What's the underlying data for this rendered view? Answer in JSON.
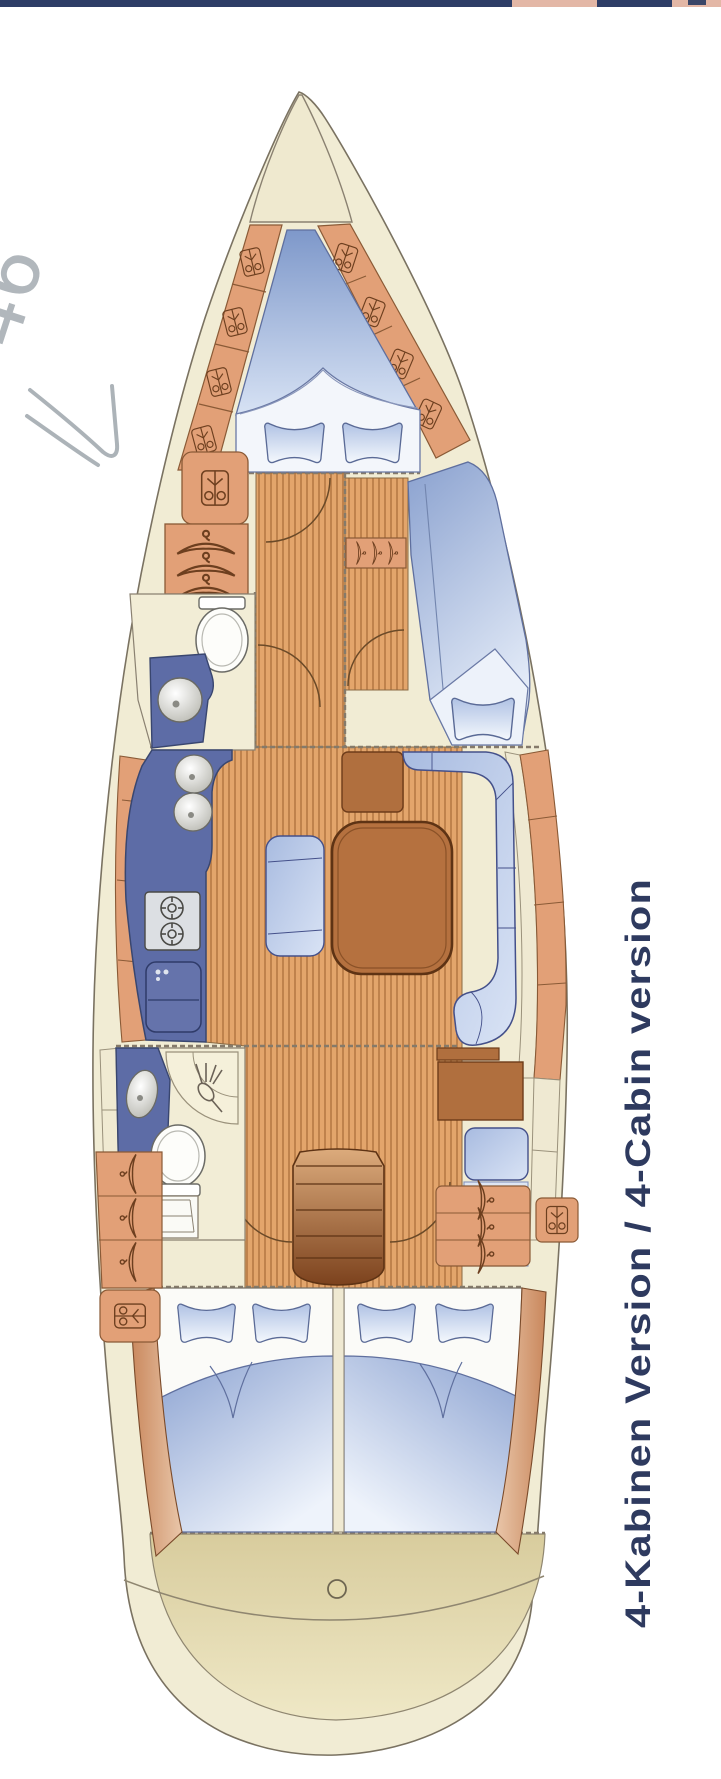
{
  "page": {
    "background": "#ffffff"
  },
  "photo_edge": {
    "navy": "#2e3d66",
    "pink": "#e3b7a6"
  },
  "handwriting": {
    "text": "46",
    "color": "#a4abb1"
  },
  "caption": {
    "text": "4-Kabinen Version / 4-Cabin version",
    "color": "#2e3a5f"
  },
  "floorplan": {
    "colors": {
      "hull_rim": "#f1ecd4",
      "anchor_locker": "#efe9cf",
      "outline": "#7a7261",
      "shelf_orange": "#e2a077",
      "shelf_line": "#8a5a36",
      "wood_light": "#e3a56b",
      "wood_stripe": "#bf824c",
      "upholstery_blue_dark": "#7e98ca",
      "upholstery_blue_light": "#d7e2f4",
      "counter_blue": "#5d6ca6",
      "table_brown": "#b5713f",
      "seat_brown": "#b06f3e",
      "steps_brown_dark": "#7c421d",
      "stern_tan": "#d8cc9d",
      "fixture_white": "#fdfdfa"
    },
    "areas": [
      "anchor-locker",
      "fore-cabin",
      "hull-shelves",
      "wardrobes",
      "fore-head",
      "corridor",
      "starboard-mid-cabin",
      "galley",
      "saloon-dinette",
      "nav-station",
      "aft-head",
      "companionway-steps",
      "aft-cabin-port",
      "aft-cabin-starboard",
      "stern-locker"
    ]
  }
}
